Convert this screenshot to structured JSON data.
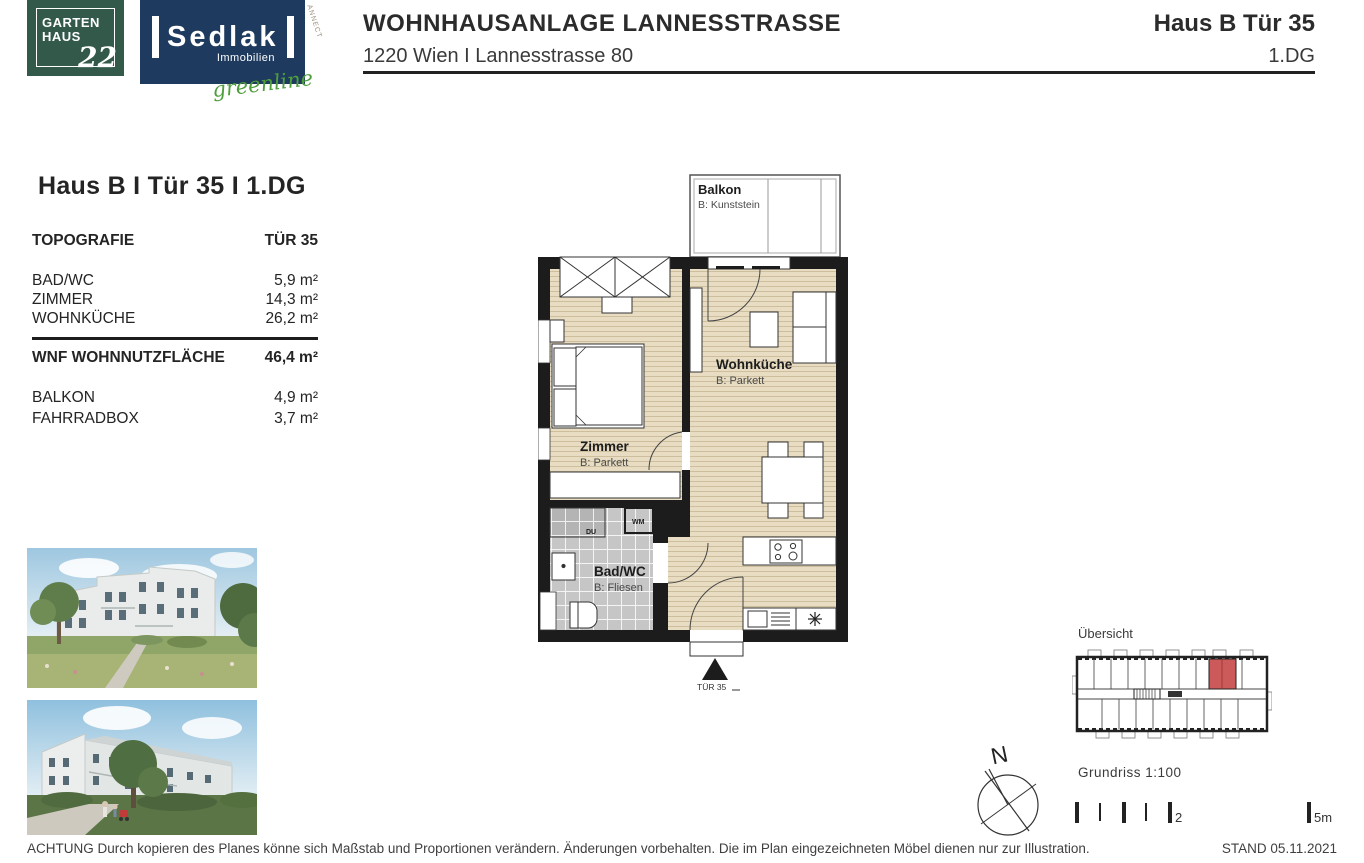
{
  "header": {
    "logo_gartenhaus": {
      "line1": "GARTEN",
      "line2": "HAUS",
      "number": "22"
    },
    "logo_sedlak": {
      "name": "Sedlak",
      "sub": "Immobilien",
      "script": "greenline"
    },
    "watermark": "ANNECT",
    "title": "WOHNHAUSANLAGE LANNESSTRASSE",
    "subtitle": "1220 Wien I Lannesstrasse 80",
    "unit_title": "Haus B Tür 35",
    "floor": "1.DG"
  },
  "info": {
    "heading": "Haus B I Tür 35 I 1.DG",
    "table": {
      "col1": "TOPOGRAFIE",
      "col2": "TÜR 35",
      "rooms": [
        {
          "label": "BAD/WC",
          "value": "5,9 m²"
        },
        {
          "label": "ZIMMER",
          "value": "14,3 m²"
        },
        {
          "label": "WOHNKÜCHE",
          "value": "26,2 m²"
        }
      ],
      "total": {
        "label": "WNF WOHNNUTZFLÄCHE",
        "value": "46,4 m²"
      },
      "extras": [
        {
          "label": "BALKON",
          "value": "4,9 m²"
        },
        {
          "label": "FAHRRADBOX",
          "value": "3,7 m²"
        }
      ]
    }
  },
  "plan": {
    "balkon": {
      "name": "Balkon",
      "material": "B: Kunststein"
    },
    "zimmer": {
      "name": "Zimmer",
      "material": "B: Parkett"
    },
    "wohnkueche": {
      "name": "Wohnküche",
      "material": "B: Parkett"
    },
    "badwc": {
      "name": "Bad/WC",
      "material": "B: Fliesen"
    },
    "wm_label": "WM",
    "du_label": "DU",
    "entry_label": "TÜR 35"
  },
  "legend": {
    "overview_label": "Übersicht",
    "compass_n": "N",
    "scale_label": "Grundriss 1:100",
    "tick_two": "2",
    "tick_five": "5m"
  },
  "footer": {
    "notice": "ACHTUNG Durch kopieren des Planes könne sich Maßstab und Proportionen verändern. Änderungen vorbehalten. Die im Plan eingezeichneten Möbel dienen nur zur Illustration.",
    "stand": "STAND 05.11.2021"
  },
  "colors": {
    "wall": "#1c1c1c",
    "parquet": "#e8dcc2",
    "tile": "#c6c6c6",
    "highlight": "#cd5a5a",
    "logo_green": "#33594b",
    "logo_navy": "#1e3a5f"
  }
}
